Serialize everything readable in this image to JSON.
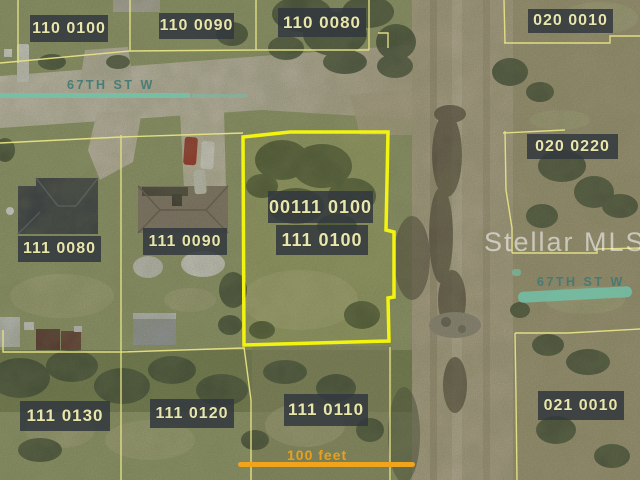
{
  "map": {
    "watermark": "Stellar MLS",
    "scale_label": "100 feet",
    "streets": [
      {
        "name": "67TH ST W",
        "side": "west"
      },
      {
        "name": "67TH ST W",
        "side": "east"
      }
    ],
    "parcels": [
      {
        "label": "110 0100",
        "highlighted": false
      },
      {
        "label": "110 0090",
        "highlighted": false
      },
      {
        "label": "110 0080",
        "highlighted": false
      },
      {
        "label": "020 0010",
        "highlighted": false
      },
      {
        "label": "020 0220",
        "highlighted": false
      },
      {
        "label": "111 0080",
        "highlighted": false
      },
      {
        "label": "111 0090",
        "highlighted": false
      },
      {
        "label": "00111 0100",
        "highlighted": true
      },
      {
        "label": "111 0100",
        "highlighted": true
      },
      {
        "label": "111 0130",
        "highlighted": false
      },
      {
        "label": "111 0120",
        "highlighted": false
      },
      {
        "label": "111 0110",
        "highlighted": false
      },
      {
        "label": "021 0010",
        "highlighted": false
      }
    ],
    "colors": {
      "parcel_line": "#e6e282",
      "highlighted_parcel": "#f3f406",
      "street_line": "#6fc4ac",
      "street_text": "#3f7a75",
      "scale_bar": "#efa41c",
      "label_background": "#32383e",
      "label_text": "#e9e6ac",
      "watermark_text": "#ffffff"
    }
  }
}
